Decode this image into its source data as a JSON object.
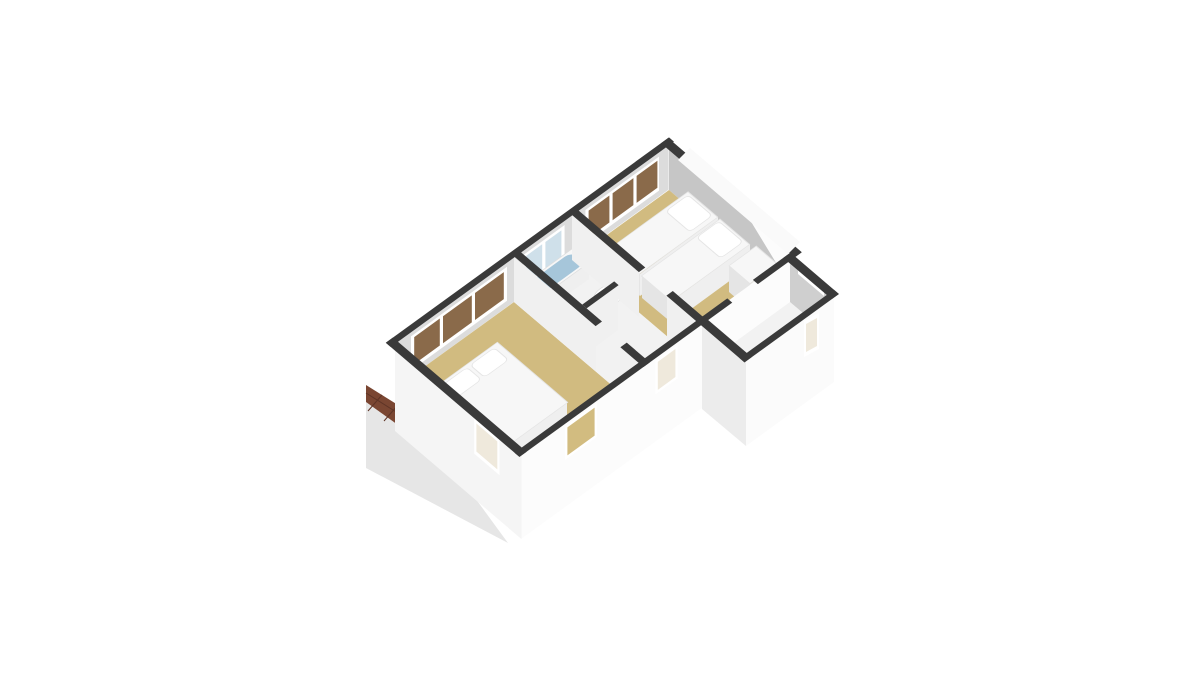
{
  "scene": {
    "type": "3d-floorplan-render",
    "view": "axonometric-top-down",
    "background": "#ffffff",
    "floors_shown": 1,
    "style": "white walls with dark wall caps, tan bedroom floors"
  },
  "palette": {
    "background": "#ffffff",
    "wall-top": "#3a3a3a",
    "wall-nw": "#dcdcdc",
    "wall-ne": "#c6c6c6",
    "wall-partition": "#f0f0f0",
    "wall-ext": "#fcfcfc",
    "wall-ext-2": "#f5f5f5",
    "annex-ne": "#cfcfcf",
    "annex-sw": "#ececec",
    "annex-se": "#fbfbfb",
    "floor-tan": "#d1bb80",
    "floor-white": "#f2f2f2",
    "bath-blue": "#a6c6da",
    "roof-brown": "#7a4632",
    "roof-line": "#5e3426",
    "roof-gray": "#e6e6e6",
    "win-brown": "#8a6a4a",
    "win-blue": "#cfe0ea",
    "win-cream": "#efe9dc",
    "win-tan": "#d2bc80",
    "white": "#ffffff",
    "band-white": "#fafafa",
    "bed-top": "#f7f7f7",
    "bed-side": "#e5e5e5",
    "bed-side-2": "#efefef",
    "soft": "#dddddd"
  },
  "rooms": [
    {
      "id": "bedroom-1",
      "position": "lower-left",
      "floor_color_key": "floor-tan",
      "furniture": [
        "double-bed",
        "two-pillows"
      ],
      "windows": [
        "nw-window-band-3-panes",
        "sw-window",
        "se-window"
      ]
    },
    {
      "id": "bathroom",
      "position": "center",
      "floor_color_key": "floor-white",
      "furniture": [
        "bathtub",
        "washbasin",
        "toilet"
      ],
      "windows": [
        "nw-window-band-2-panes"
      ]
    },
    {
      "id": "hallway",
      "position": "center-south",
      "floor_color_key": "floor-white",
      "furniture": [],
      "windows": [
        "se-window"
      ]
    },
    {
      "id": "bedroom-2",
      "position": "upper-right",
      "floor_color_key": "floor-tan",
      "furniture": [
        "single-bed",
        "single-bed",
        "dresser"
      ],
      "windows": [
        "nw-window-band-3-panes"
      ]
    },
    {
      "id": "annex",
      "position": "right",
      "floor_color_key": "floor-white",
      "furniture": [],
      "windows": [
        "se-narrow-window",
        "ne-opening"
      ]
    }
  ],
  "exterior": {
    "roof": "brown-tiled-slope-lower-left",
    "roof_slope": "light-gray-plane-below-tiles",
    "ne-corner": "white-sloped-roof-band"
  }
}
